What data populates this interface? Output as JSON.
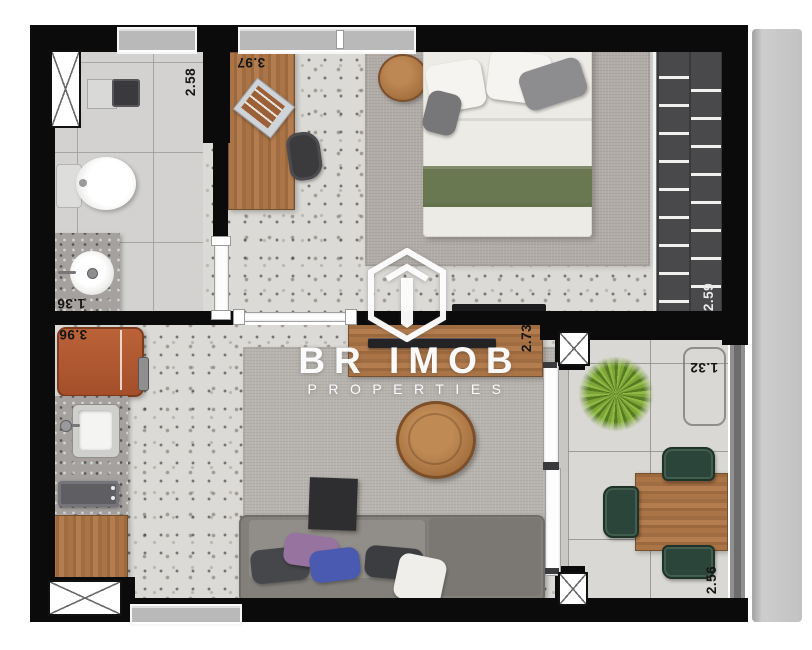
{
  "watermark": {
    "brand": "BR IMOB",
    "tagline": "PROPERTIES"
  },
  "dimensions": {
    "laundry": "2.58",
    "home_office": "3.97",
    "bathroom": "1.36",
    "kitchen": "3.96",
    "living_room": "2.73",
    "closet": "2.59",
    "balcony_width": "1.32",
    "balcony_length": "2.56"
  },
  "colors": {
    "wall": "#0b0b0b",
    "wood": "#a9744a",
    "fridge_orange": "#b35c35",
    "bed_blanket_green": "#6a7852",
    "balcony_chair_green": "#2c453a",
    "plant_green": "#7ca437",
    "watermark_white": "#ffffff"
  }
}
